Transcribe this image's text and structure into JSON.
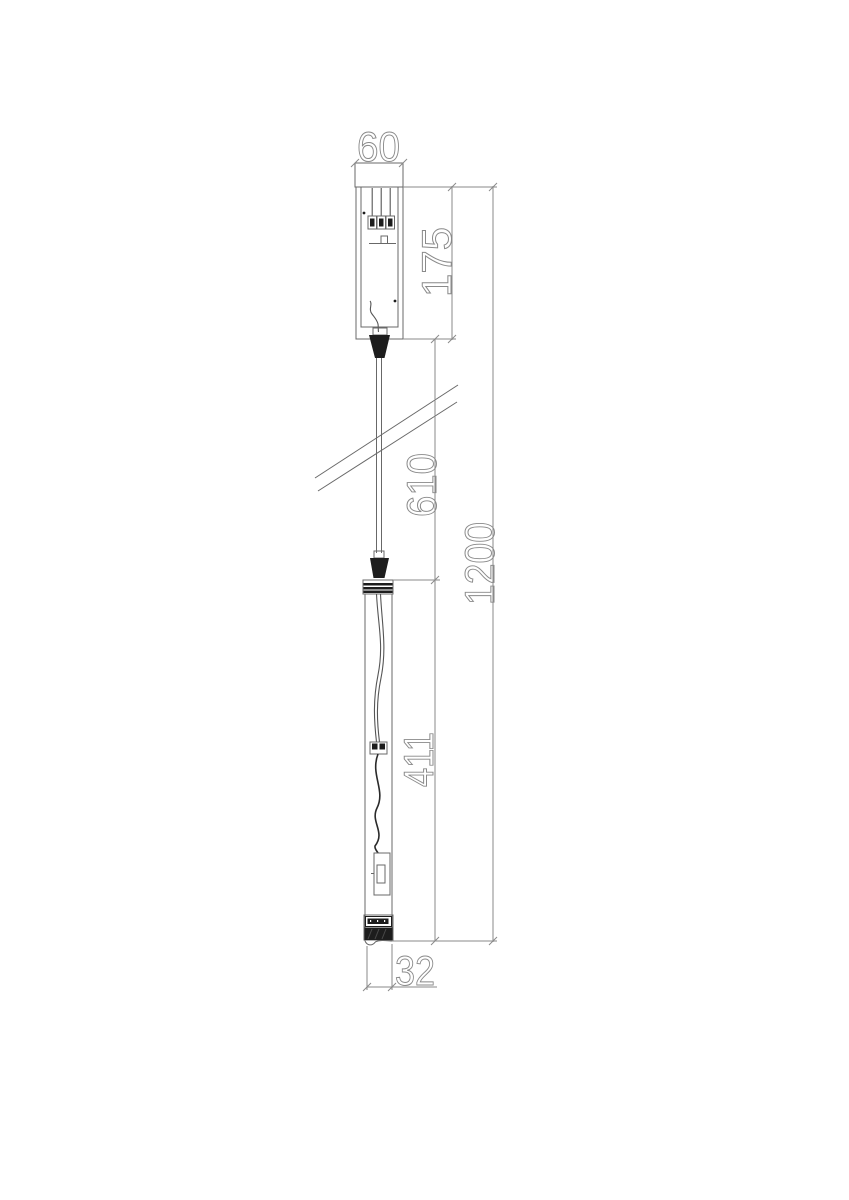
{
  "drawing": {
    "dimensions": {
      "canopy_width_mm": "60",
      "canopy_height_mm": "175",
      "suspension_length_mm": "610",
      "overall_drop_mm": "1200",
      "fixture_length_mm": "411",
      "fixture_width_mm": "32"
    },
    "colors": {
      "line": "#686868",
      "dim": "#8a8a8a",
      "dark": "#1d1d1d",
      "background": "#ffffff"
    }
  }
}
